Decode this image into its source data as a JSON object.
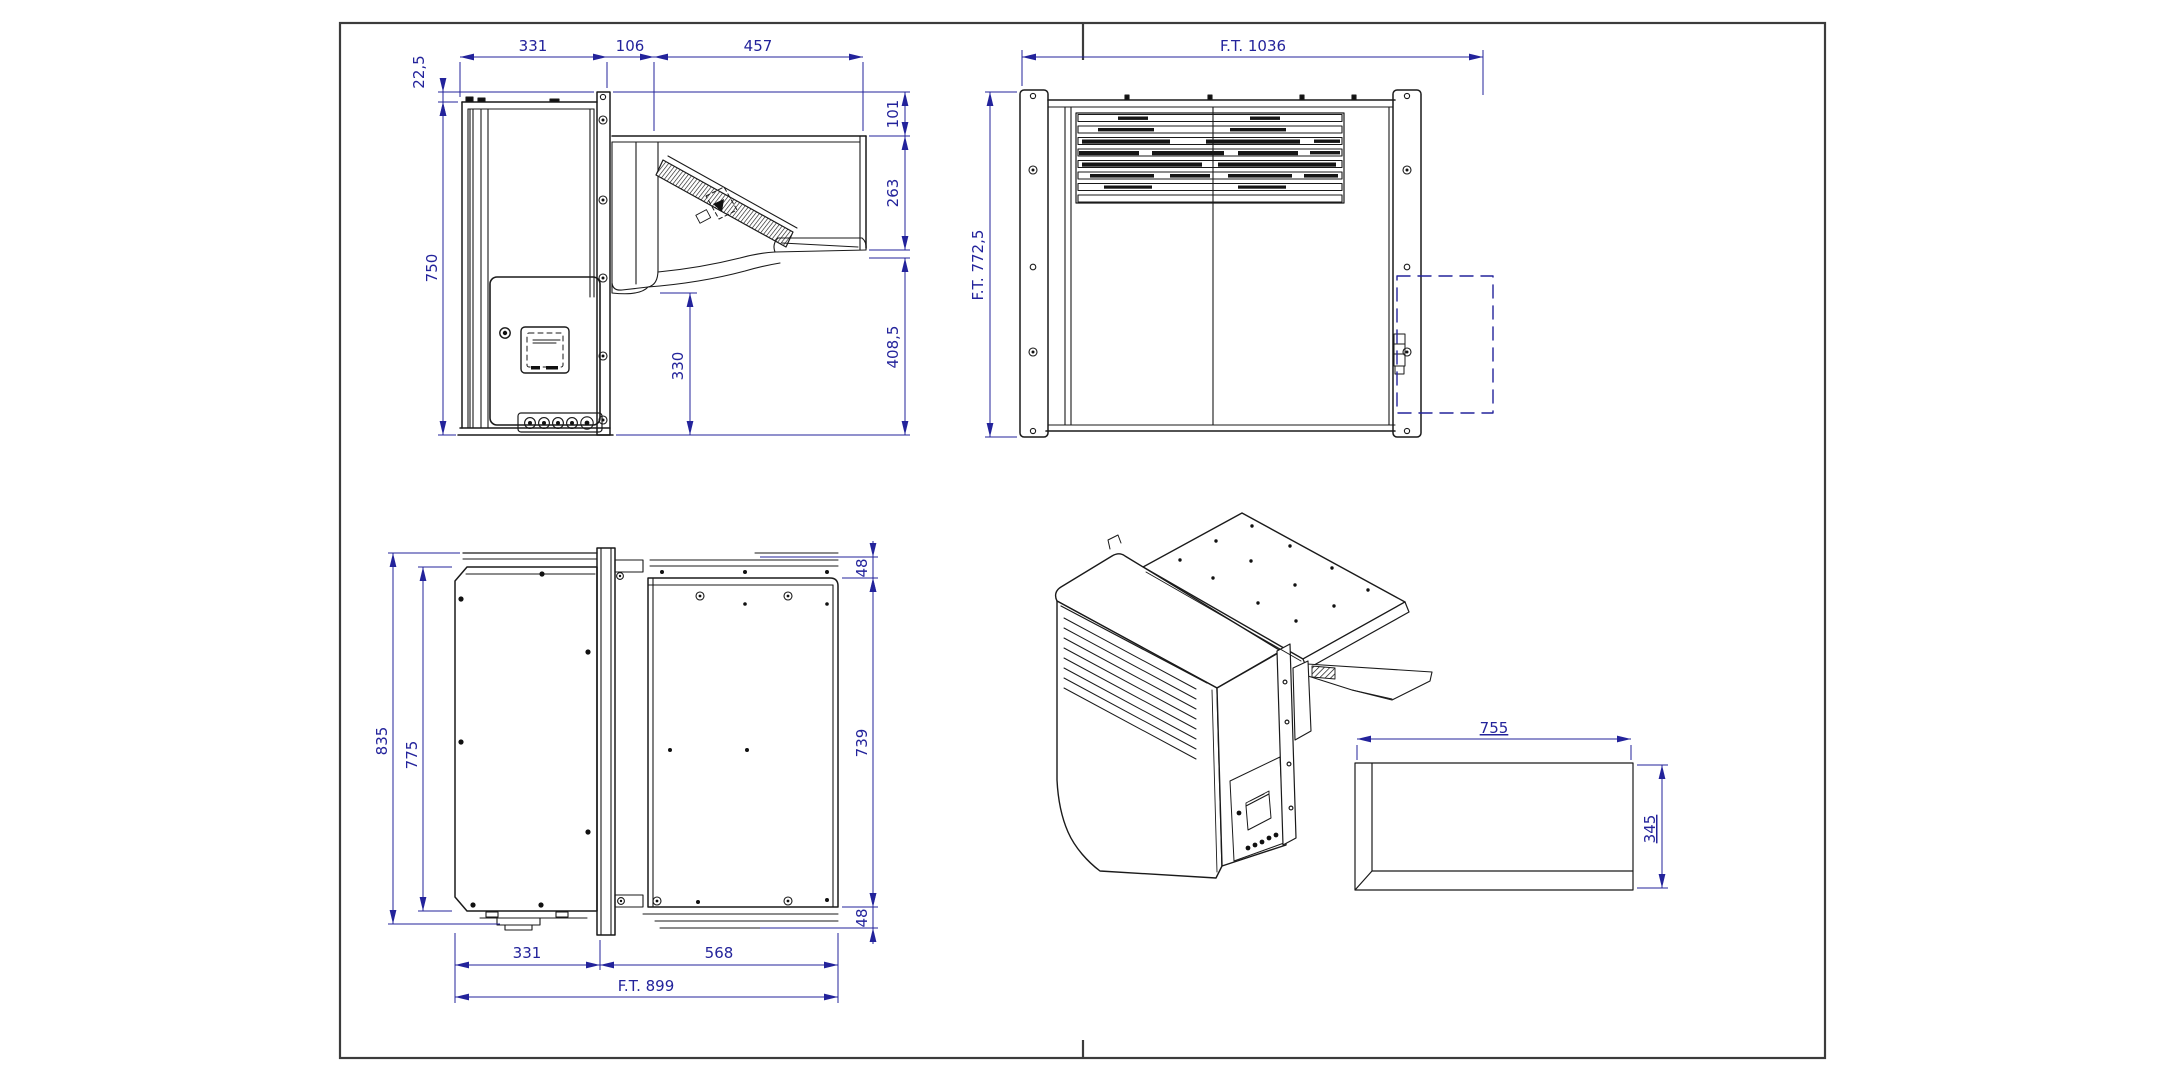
{
  "page": {
    "background": "#ffffff",
    "frame_color": "#3c3c3c"
  },
  "drawing": {
    "subject": "monoblock refrigeration unit - dimensioned views",
    "geometry_color": "#1a1a1a",
    "dimension_color": "#23239b",
    "views": {
      "side_view": {
        "dims": {
          "offset_top": "22,5",
          "indoor_depth": "331",
          "wall_thickness": "106",
          "outdoor_depth": "457",
          "indoor_height": "750",
          "bottom_clearance": "330",
          "top_drop": "101",
          "condenser_height": "263",
          "lower_height": "408,5"
        }
      },
      "front_view": {
        "dims": {
          "ft_width": "F.T. 1036",
          "ft_height": "F.T. 772,5"
        }
      },
      "plan_view": {
        "dims": {
          "overall_depth": "835",
          "panel_depth": "775",
          "bracket_top": "48",
          "panel_width": "739",
          "bracket_bottom": "48",
          "indoor_depth": "331",
          "outdoor_depth": "568",
          "ft_depth": "F.T. 899"
        }
      },
      "wall_opening": {
        "dims": {
          "width": "755",
          "height": "345"
        }
      }
    }
  }
}
